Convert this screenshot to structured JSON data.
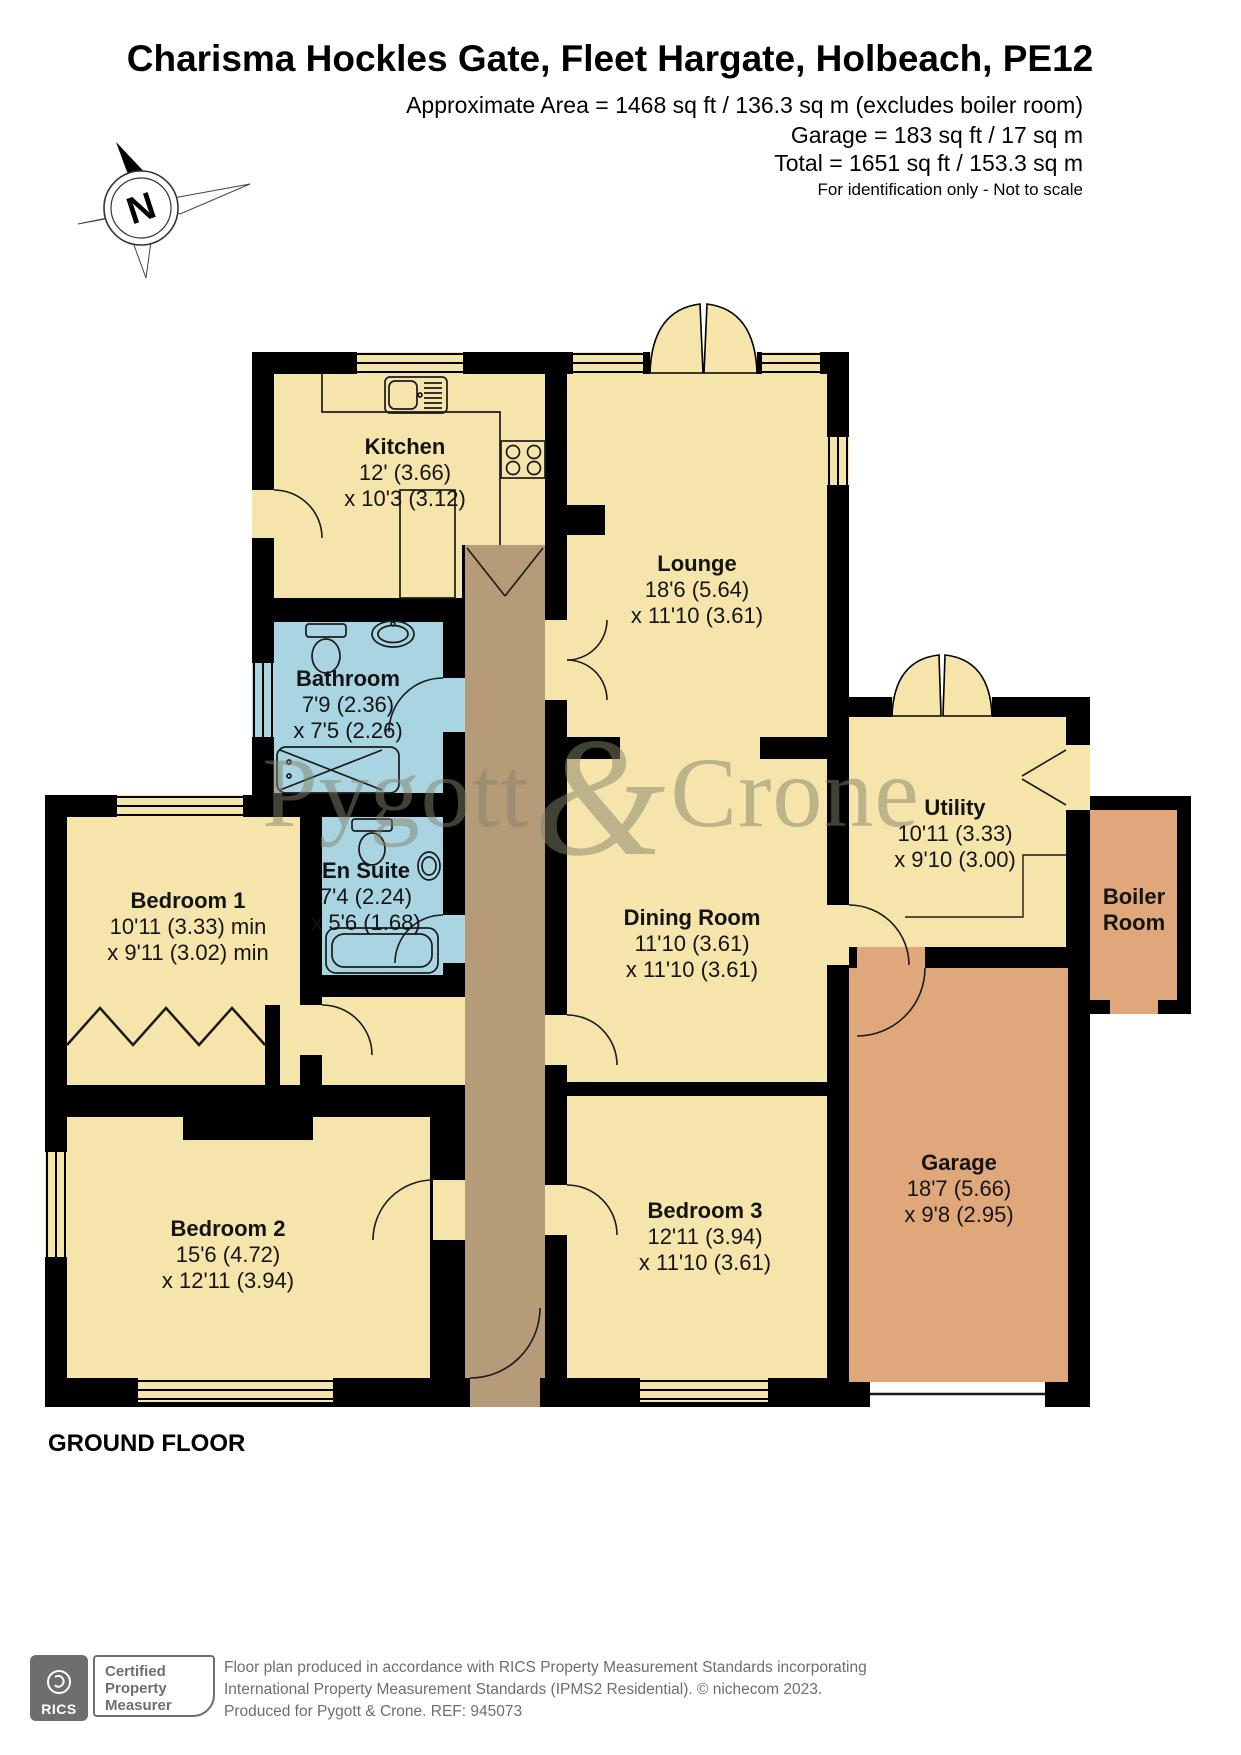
{
  "header": {
    "title": "Charisma Hockles Gate, Fleet Hargate, Holbeach, PE12",
    "approx_area": "Approximate Area = 1468 sq ft / 136.3 sq m (excludes boiler room)",
    "garage_area": "Garage = 183 sq ft / 17 sq m",
    "total_area": "Total = 1651 sq ft / 153.3 sq m",
    "disclaimer": "For identification only - Not to scale"
  },
  "compass": {
    "north_label": "N"
  },
  "watermark": {
    "word1": "Pygott",
    "ampersand": "&",
    "word2": "Crone"
  },
  "floor_label": "GROUND FLOOR",
  "rooms": [
    {
      "id": "kitchen",
      "name": "Kitchen",
      "dim1": "12' (3.66)",
      "dim2": "x 10'3 (3.12)"
    },
    {
      "id": "lounge",
      "name": "Lounge",
      "dim1": "18'6 (5.64)",
      "dim2": "x 11'10 (3.61)"
    },
    {
      "id": "bathroom",
      "name": "Bathroom",
      "dim1": "7'9 (2.36)",
      "dim2": "x 7'5 (2.26)"
    },
    {
      "id": "ensuite",
      "name": "En Suite",
      "dim1": "7'4 (2.24)",
      "dim2": "x 5'6 (1.68)"
    },
    {
      "id": "bedroom1",
      "name": "Bedroom 1",
      "dim1": "10'11 (3.33) min",
      "dim2": "x 9'11 (3.02) min"
    },
    {
      "id": "dining",
      "name": "Dining Room",
      "dim1": "11'10 (3.61)",
      "dim2": "x 11'10 (3.61)"
    },
    {
      "id": "utility",
      "name": "Utility",
      "dim1": "10'11 (3.33)",
      "dim2": "x 9'10 (3.00)"
    },
    {
      "id": "boiler",
      "name": "Boiler Room"
    },
    {
      "id": "garage",
      "name": "Garage",
      "dim1": "18'7 (5.66)",
      "dim2": "x 9'8 (2.95)"
    },
    {
      "id": "bedroom2",
      "name": "Bedroom 2",
      "dim1": "15'6 (4.72)",
      "dim2": "x 12'11 (3.94)"
    },
    {
      "id": "bedroom3",
      "name": "Bedroom 3",
      "dim1": "12'11 (3.94)",
      "dim2": "x 11'10 (3.61)"
    }
  ],
  "footer": {
    "rics_logo_text": "RICS",
    "badge_line1": "Certified",
    "badge_line2": "Property",
    "badge_line3": "Measurer",
    "line1": "Floor plan produced in accordance with RICS Property Measurement Standards incorporating",
    "line2": "International Property Measurement Standards (IPMS2 Residential).    © nichecom 2023.",
    "line3": "Produced for Pygott & Crone.    REF: 945073"
  },
  "colors": {
    "room_yellow": "#F6E5AB",
    "wet_blue": "#A9D4E2",
    "hall_brown": "#B69B79",
    "garage_orange": "#E0A87A",
    "wall_black": "#000000",
    "watermark_gray": "#82826A"
  }
}
